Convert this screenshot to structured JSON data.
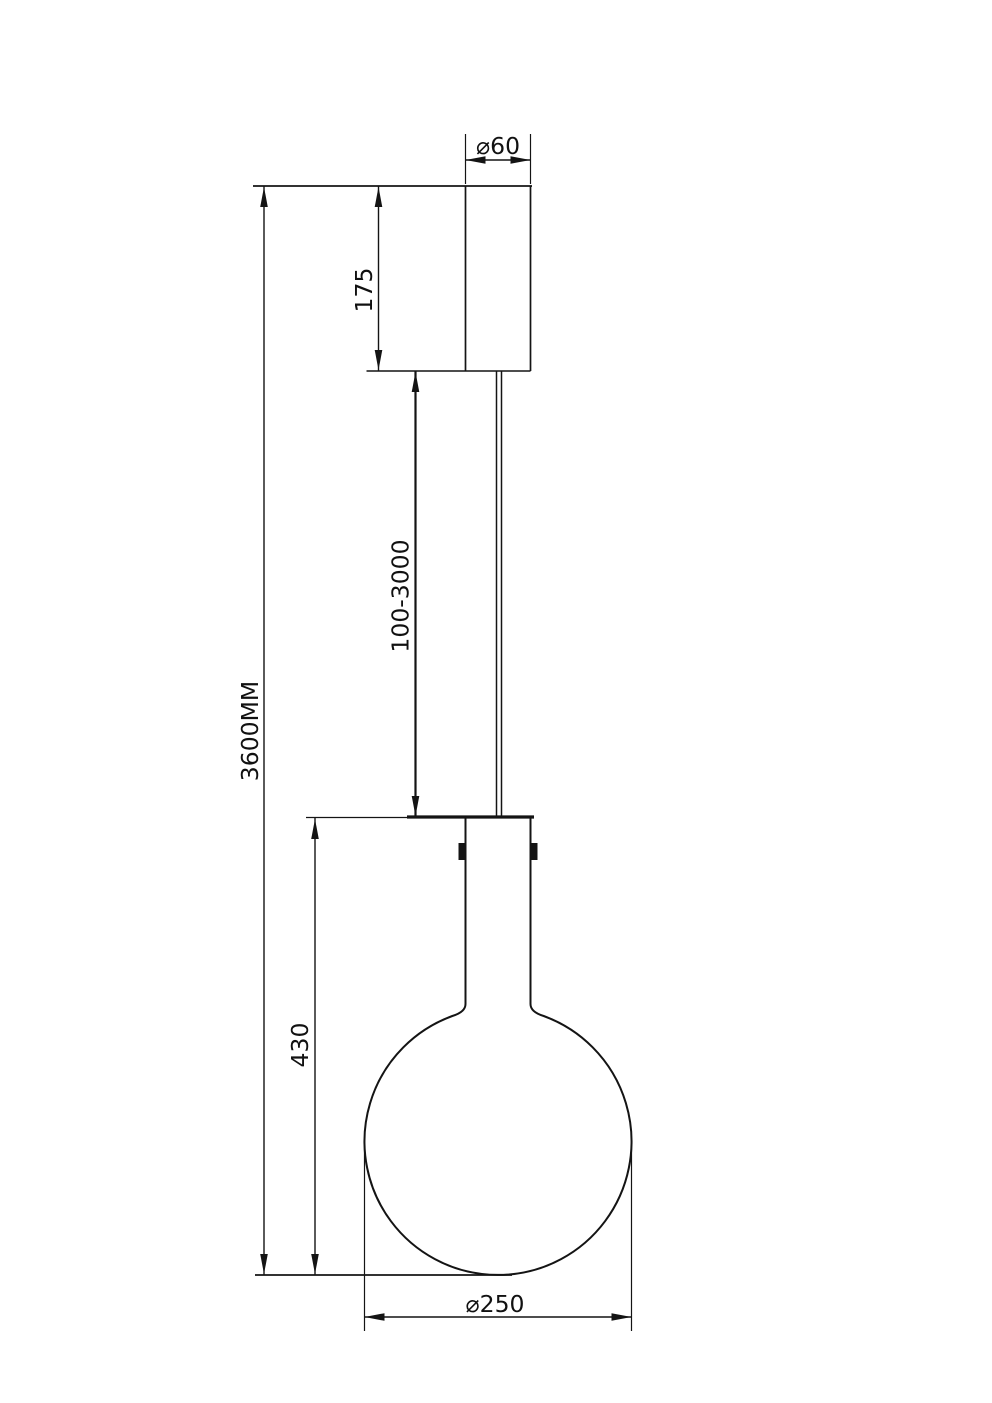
{
  "drawing": {
    "labels": {
      "canopy_diameter": "⌀60",
      "canopy_height": "175",
      "suspension_length": "100-3000",
      "total_height": "3600MM",
      "shade_height": "430",
      "shade_diameter": "⌀250"
    }
  }
}
